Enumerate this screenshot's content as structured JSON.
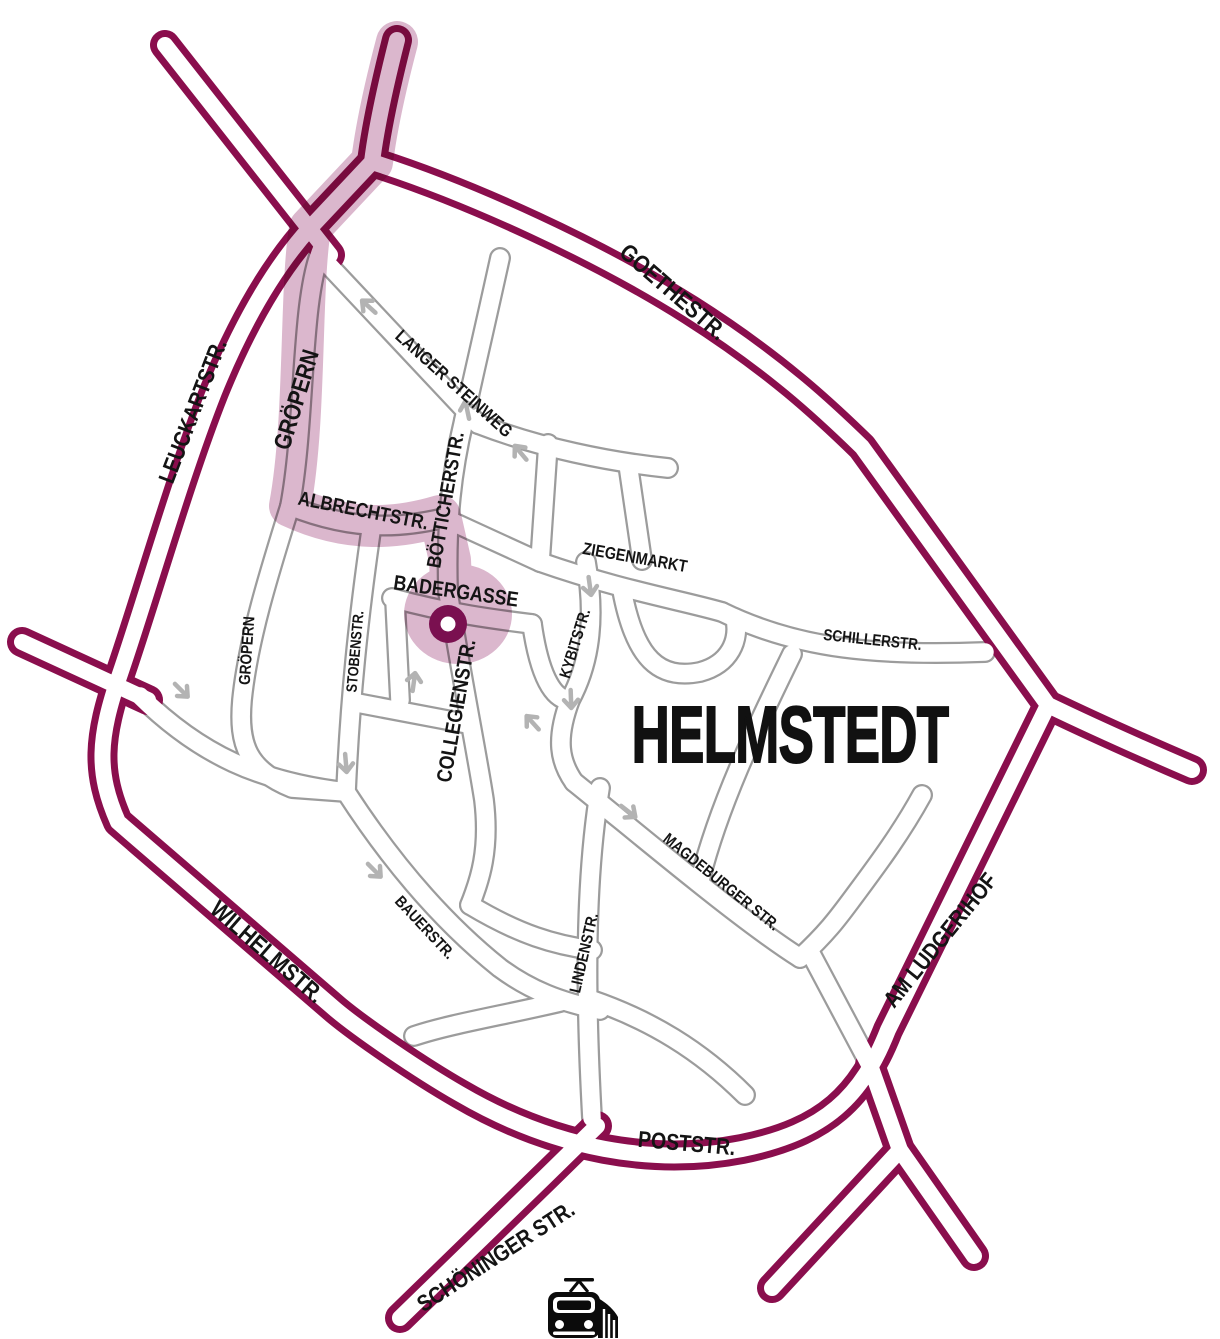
{
  "title": "HELMSTEDT",
  "colors": {
    "ring_road": "#8A0E4D",
    "route_highlight": "#DBB7CD",
    "destination_marker": "#7A1050",
    "street_casing": "#9C9C9C",
    "one_way_arrow": "#B3B3B3",
    "label_text": "#141414"
  },
  "labels": {
    "goethestr": "GOETHESTR.",
    "leuckartstr": "LEUCKARTSTR.",
    "wilhelmstr": "WILHELMSTR.",
    "poststr": "POSTSTR.",
    "am_ludgerihof": "AM LUDGERIHOF",
    "schoeninger_str": "SCHÖNINGER STR.",
    "langer_steinweg": "LANGER STEINWEG",
    "groepern_route": "GRÖPERN",
    "groepern_south": "GRÖPERN",
    "albrechtstr": "ALBRECHTSTR.",
    "boetticherstr": "BÖTTICHERSTR.",
    "badergasse": "BADERGASSE",
    "ziegenmarkt": "ZIEGENMARKT",
    "schillerstr": "SCHILLERSTR.",
    "stobenstr": "STOBENSTR.",
    "kybitstr": "KYBITSTR.",
    "collegienstr": "COLLEGIENSTR.",
    "magdeburger_str": "MAGDEBURGER STR.",
    "bauerstr": "BAUERSTR.",
    "lindenstr": "LINDENSTR."
  },
  "route": {
    "streets": [
      "GRÖPERN",
      "ALBRECHTSTR.",
      "BÖTTICHERSTR.",
      "BADERGASSE"
    ],
    "destination": "BADERGASSE"
  },
  "marker": {
    "type": "destination-dot"
  },
  "station": {
    "icon": "train-icon"
  }
}
